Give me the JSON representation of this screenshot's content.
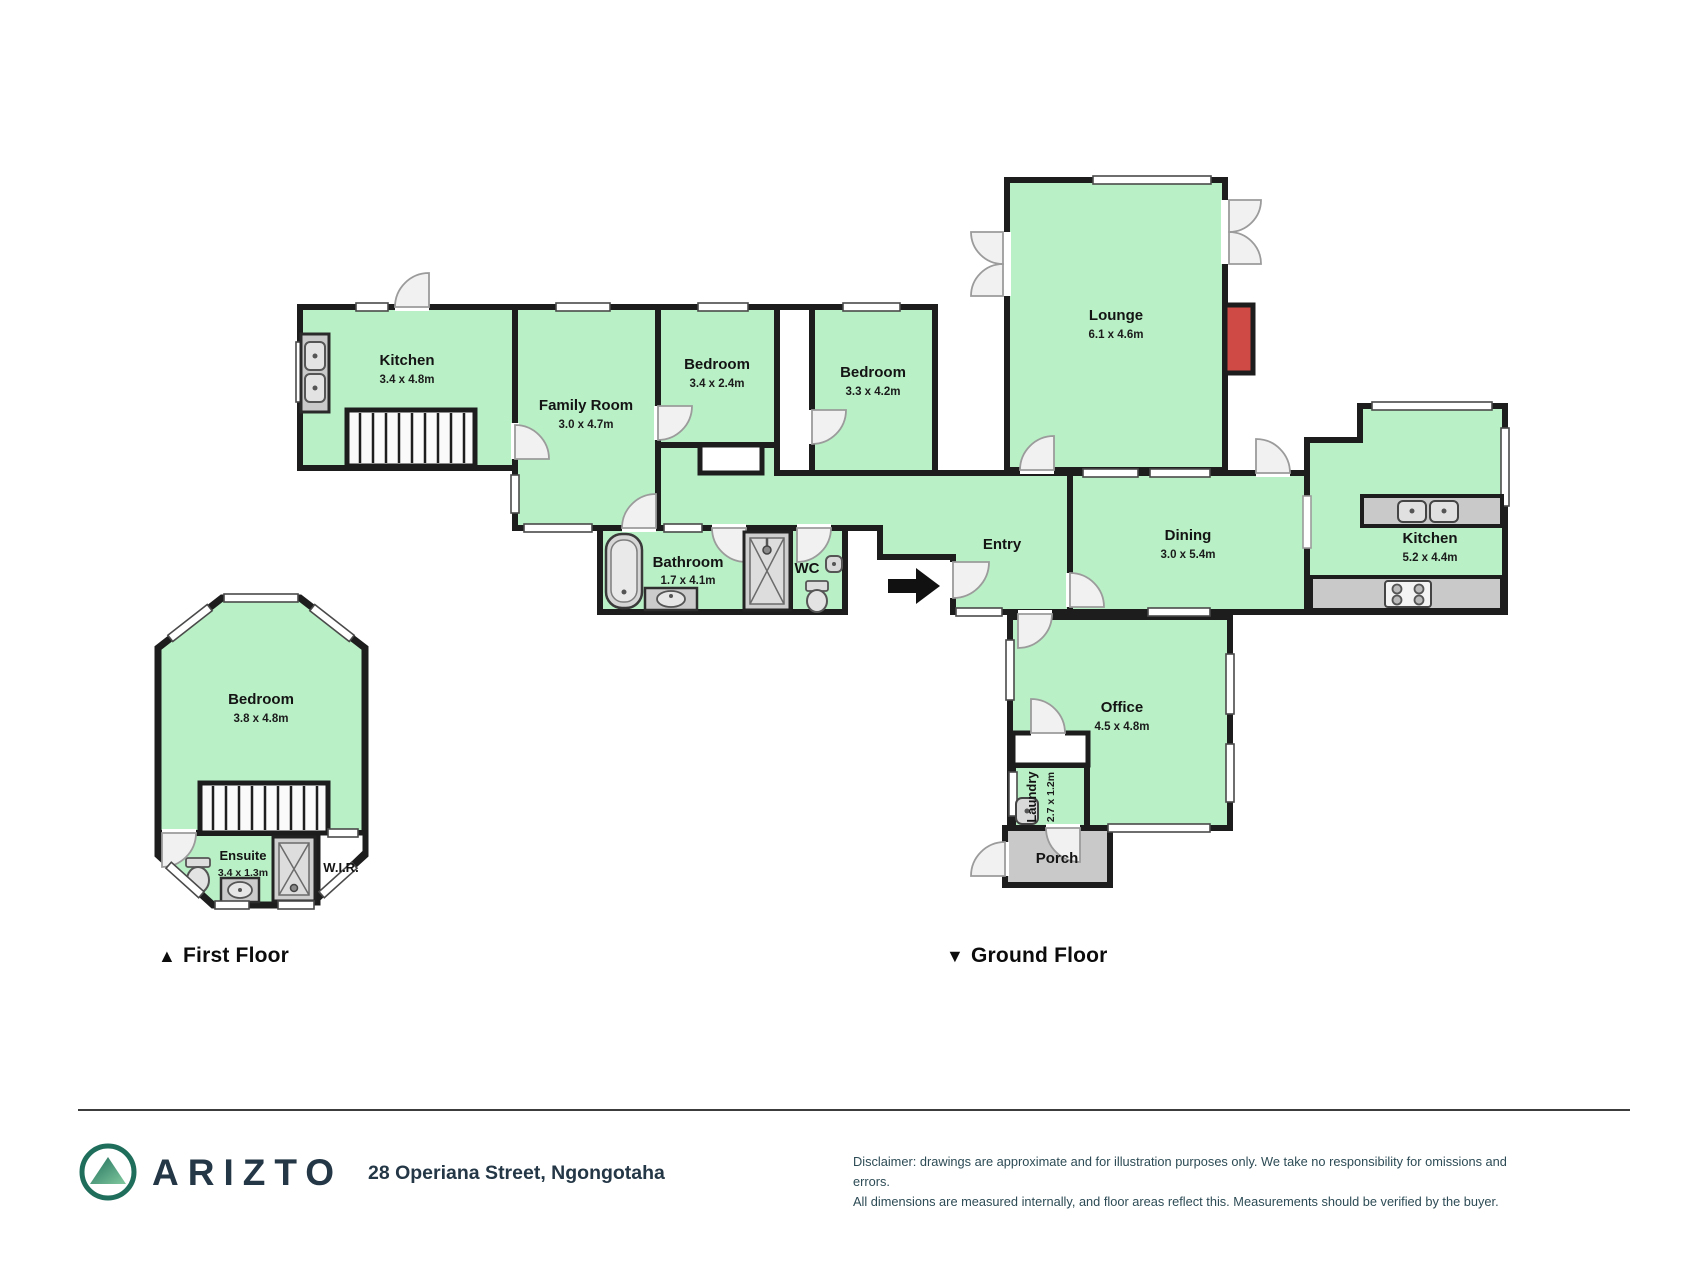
{
  "palette": {
    "room_fill": "#b9f0c6",
    "wall": "#1d1d1d",
    "door_leaf": "#f1f1f1",
    "fixture_gray": "#c9c9c9",
    "porch_fill": "#c9c9c9",
    "fireplace_red": "#cf4a45",
    "brand_dark": "#243746",
    "logo_green": "#2a7a64"
  },
  "floors": {
    "first": {
      "marker": "▲",
      "label": "First Floor",
      "rooms": {
        "bedroom": {
          "name": "Bedroom",
          "dims": "3.8 x 4.8m"
        },
        "ensuite": {
          "name": "Ensuite",
          "dims": "3.4 x 1.3m"
        },
        "wir": {
          "name": "W.I.R."
        }
      }
    },
    "ground": {
      "marker": "▼",
      "label": "Ground Floor",
      "rooms": {
        "kitchen_left": {
          "name": "Kitchen",
          "dims": "3.4 x 4.8m"
        },
        "family": {
          "name": "Family Room",
          "dims": "3.0 x 4.7m"
        },
        "bedroom_small": {
          "name": "Bedroom",
          "dims": "3.4 x 2.4m"
        },
        "bedroom_mid": {
          "name": "Bedroom",
          "dims": "3.3 x 4.2m"
        },
        "lounge": {
          "name": "Lounge",
          "dims": "6.1 x 4.6m"
        },
        "entry": {
          "name": "Entry"
        },
        "dining": {
          "name": "Dining",
          "dims": "3.0 x 5.4m"
        },
        "kitchen_right": {
          "name": "Kitchen",
          "dims": "5.2 x 4.4m"
        },
        "bathroom": {
          "name": "Bathroom",
          "dims": "1.7 x 4.1m"
        },
        "wc": {
          "name": "WC"
        },
        "office": {
          "name": "Office",
          "dims": "4.5 x 4.8m"
        },
        "laundry": {
          "name": "Laundry",
          "dims": "2.7 x 1.2m"
        },
        "porch": {
          "name": "Porch"
        }
      }
    }
  },
  "footer": {
    "brand": "ARIZTO",
    "address": "28 Operiana Street, Ngongotaha",
    "disclaimer_line1": "Disclaimer: drawings are approximate and for illustration purposes only. We take no responsibility for omissions and errors.",
    "disclaimer_line2": "All dimensions are measured internally, and floor areas reflect this. Measurements should be verified by the buyer."
  }
}
